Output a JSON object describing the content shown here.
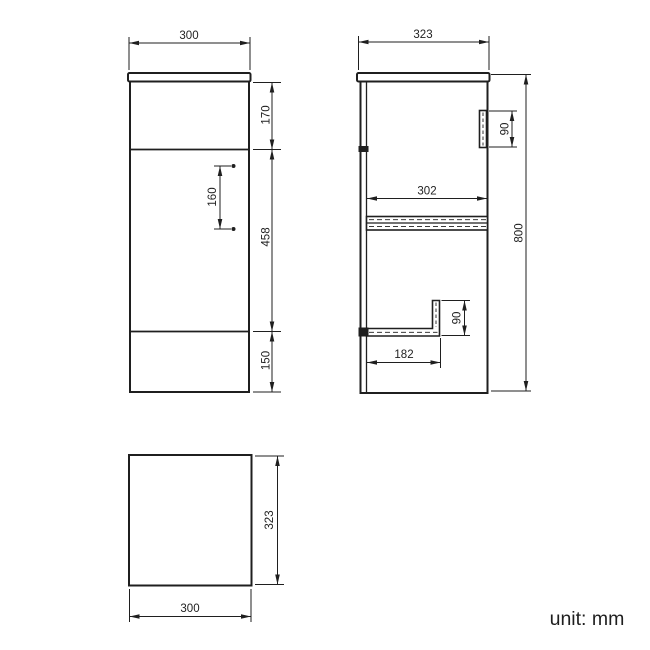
{
  "title": "Cabinet dimension drawing",
  "unit_label": "unit: mm",
  "colors": {
    "line": "#1f1f1f",
    "background": "#ffffff"
  },
  "front_view": {
    "width_mm": "300",
    "top_section_height_mm": "170",
    "door_height_mm": "458",
    "plinth_height_mm": "150",
    "handle_hole_spacing_mm": "160"
  },
  "side_view": {
    "depth_mm": "323",
    "height_mm": "800",
    "handle_length_mm": "90",
    "internal_depth_mm": "302",
    "recess_height_mm": "90",
    "recess_depth_mm": "182"
  },
  "top_view": {
    "depth_mm": "323",
    "width_mm": "300"
  }
}
